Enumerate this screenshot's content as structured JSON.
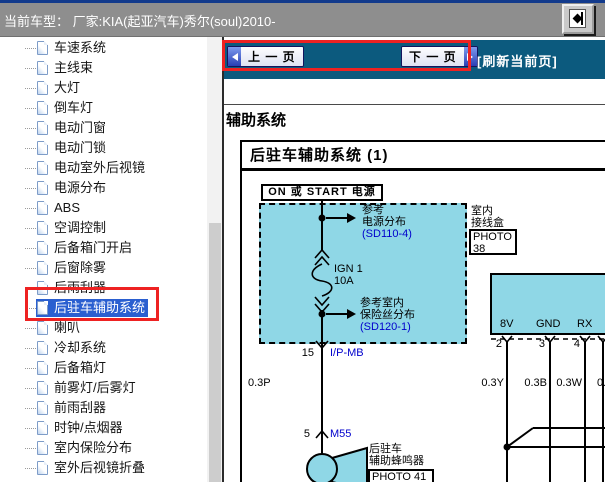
{
  "window": {
    "title": "当前车型：  厂家:KIA(起亚汽车)秀尔(soul)2010-"
  },
  "sidebar": {
    "items": [
      {
        "label": "车速系统",
        "selected": false
      },
      {
        "label": "主线束",
        "selected": false
      },
      {
        "label": "大灯",
        "selected": false
      },
      {
        "label": "倒车灯",
        "selected": false
      },
      {
        "label": "电动门窗",
        "selected": false
      },
      {
        "label": "电动门锁",
        "selected": false
      },
      {
        "label": "电动室外后视镜",
        "selected": false
      },
      {
        "label": "电源分布",
        "selected": false
      },
      {
        "label": "ABS",
        "selected": false
      },
      {
        "label": "空调控制",
        "selected": false
      },
      {
        "label": "后备箱门开启",
        "selected": false
      },
      {
        "label": "后窗除雾",
        "selected": false
      },
      {
        "label": "后雨刮器",
        "selected": false
      },
      {
        "label": "后驻车辅助系统",
        "selected": true
      },
      {
        "label": "喇叭",
        "selected": false
      },
      {
        "label": "冷却系统",
        "selected": false
      },
      {
        "label": "后备箱灯",
        "selected": false
      },
      {
        "label": "前雾灯/后雾灯",
        "selected": false
      },
      {
        "label": "前雨刮器",
        "selected": false
      },
      {
        "label": "时钟/点烟器",
        "selected": false
      },
      {
        "label": "室内保险分布",
        "selected": false
      },
      {
        "label": "室外后视镜折叠",
        "selected": false
      }
    ]
  },
  "nav": {
    "prev": "上 一 页",
    "next": "下 一 页",
    "refresh": "[刷新当前页]"
  },
  "content": {
    "section_heading": "辅助系统",
    "diagram_title": "后驻车辅助系统 (1)"
  },
  "diagram": {
    "power_source": "ON 或 START 电源",
    "ref_power": {
      "line1": "参考",
      "line2": "电源分布",
      "link": "(SD110-4)"
    },
    "fuse": {
      "name": "IGN 1",
      "rating": "10A"
    },
    "ref_fuse": {
      "line1": "参考室内",
      "line2": "保险丝分布",
      "link": "(SD120-1)"
    },
    "pin15": "15",
    "connector_ipmb": "I/P-MB",
    "wire_main": "0.3P",
    "pin5": "5",
    "connector_m55": "M55",
    "buzzer": {
      "line1": "后驻车",
      "line2": "辅助蜂鸣器",
      "photo": "PHOTO 41"
    },
    "junction_box": {
      "line1": "室内",
      "line2": "接线盒",
      "photo_line1": "PHOTO",
      "photo_line2": "38"
    },
    "module": {
      "pins": [
        "8V",
        "GND",
        "RX"
      ],
      "pin_numbers": [
        "2",
        "3",
        "4"
      ],
      "wires": [
        "0.3Y",
        "0.3B",
        "0.3W",
        "0."
      ]
    }
  },
  "colors": {
    "nav_blue": "#0c5a7e",
    "diagram_cyan": "#8fd7e6",
    "selection_blue": "#2a5fd0",
    "annotation_red": "#ee2222",
    "link_blue": "#0000cc",
    "titlebar_gray": "#8e8e8e"
  }
}
